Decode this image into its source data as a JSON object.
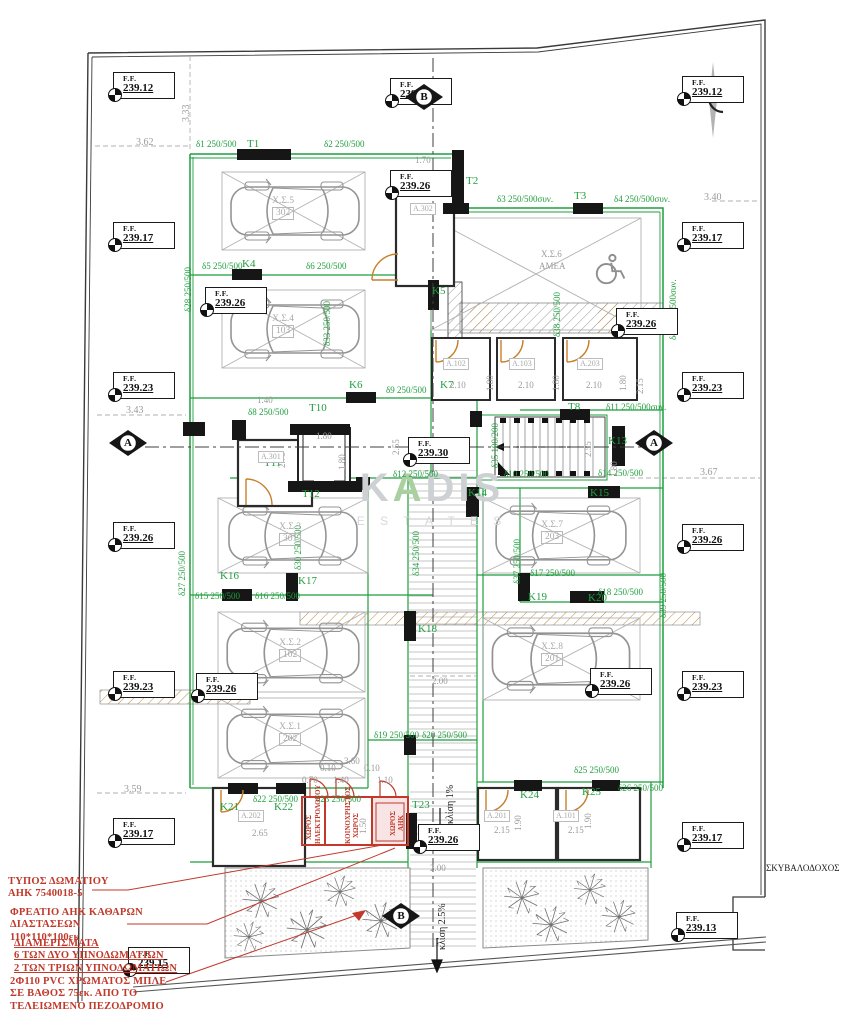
{
  "meta": {
    "width": 862,
    "height": 1024,
    "drawing": "ground floor / parking level plan"
  },
  "colors": {
    "structural_green": "#1f9e3e",
    "annotation_red": "#c0392b",
    "dim_gray": "#9b9b9b",
    "door_orange": "#c87f2a",
    "line_black": "#1a1a1a"
  },
  "watermark": {
    "k": "K",
    "a": "A",
    "dis": "DIS",
    "sub": "E S T A T E S"
  },
  "ff_label": "F.F.",
  "ff_markers": [
    {
      "x": 113,
      "y": 72,
      "v": "239.12"
    },
    {
      "x": 113,
      "y": 222,
      "v": "239.17"
    },
    {
      "x": 113,
      "y": 372,
      "v": "239.23"
    },
    {
      "x": 113,
      "y": 522,
      "v": "239.26"
    },
    {
      "x": 113,
      "y": 671,
      "v": "239.23"
    },
    {
      "x": 113,
      "y": 818,
      "v": "239.17"
    },
    {
      "x": 682,
      "y": 76,
      "v": "239.12"
    },
    {
      "x": 682,
      "y": 222,
      "v": "239.17"
    },
    {
      "x": 682,
      "y": 372,
      "v": "239.23"
    },
    {
      "x": 616,
      "y": 308,
      "v": "239.26"
    },
    {
      "x": 682,
      "y": 524,
      "v": "239.26"
    },
    {
      "x": 682,
      "y": 671,
      "v": "239.23"
    },
    {
      "x": 682,
      "y": 822,
      "v": "239.17"
    },
    {
      "x": 676,
      "y": 912,
      "v": "239.13"
    },
    {
      "x": 390,
      "y": 78,
      "v": "239.19"
    },
    {
      "x": 390,
      "y": 170,
      "v": "239.26"
    },
    {
      "x": 205,
      "y": 287,
      "v": "239.26"
    },
    {
      "x": 408,
      "y": 437,
      "v": "239.30"
    },
    {
      "x": 196,
      "y": 673,
      "v": "239.26"
    },
    {
      "x": 590,
      "y": 668,
      "v": "239.26"
    },
    {
      "x": 418,
      "y": 824,
      "v": "239.26"
    },
    {
      "x": 128,
      "y": 947,
      "v": "239.15"
    }
  ],
  "section_markers": [
    {
      "x": 404,
      "y": 80,
      "letter": "B"
    },
    {
      "x": 381,
      "y": 899,
      "letter": "B"
    },
    {
      "x": 108,
      "y": 426,
      "letter": "A"
    },
    {
      "x": 634,
      "y": 426,
      "letter": "A"
    }
  ],
  "parking_labels": [
    {
      "x": 272,
      "y": 196,
      "name": "Χ.Σ.5",
      "num": "302"
    },
    {
      "x": 272,
      "y": 314,
      "name": "Χ.Σ.4",
      "num": "103"
    },
    {
      "x": 279,
      "y": 522,
      "name": "Χ.Σ.3",
      "num": "301"
    },
    {
      "x": 279,
      "y": 638,
      "name": "Χ.Σ.2",
      "num": "102"
    },
    {
      "x": 279,
      "y": 722,
      "name": "Χ.Σ.1",
      "num": "202"
    },
    {
      "x": 541,
      "y": 520,
      "name": "Χ.Σ.7",
      "num": "203"
    },
    {
      "x": 541,
      "y": 642,
      "name": "Χ.Σ.8",
      "num": "201"
    }
  ],
  "room_labels": [
    {
      "x": 410,
      "y": 203,
      "t": "A.302"
    },
    {
      "x": 258,
      "y": 451,
      "t": "A.301"
    },
    {
      "x": 443,
      "y": 358,
      "t": "A.102"
    },
    {
      "x": 509,
      "y": 358,
      "t": "A.103"
    },
    {
      "x": 577,
      "y": 358,
      "t": "A.203"
    },
    {
      "x": 238,
      "y": 810,
      "t": "A.202"
    },
    {
      "x": 484,
      "y": 810,
      "t": "A.201"
    },
    {
      "x": 553,
      "y": 810,
      "t": "A.101"
    }
  ],
  "annotations": [
    {
      "x": 8,
      "y": 876,
      "underline": false,
      "lines": [
        "ΤΥΠΟΣ  ΔΩΜΑΤΙΟΥ",
        "ΑΗΚ  7540018-5"
      ]
    },
    {
      "x": 10,
      "y": 907,
      "underline": false,
      "lines": [
        "ΦΡΕΑΤΙΟ  ΑΗΚ  ΚΑΘΑΡΩΝ",
        "ΔΙΑΣΤΑΣΕΩΝ",
        "110*110*100εκ"
      ]
    },
    {
      "x": 14,
      "y": 938,
      "underline": true,
      "lines": [
        "      ΔΙΑΜΕΡΙΣΜΑΤΑ",
        "6  ΤΩΝ  ΔΥΟ  ΥΠΝΟΔΩΜΑΤΙΩΝ",
        "2  ΤΩΝ  ΤΡΙΩΝ  ΥΠΝΟΔΩΜΑΤΙΩΝ"
      ]
    },
    {
      "x": 10,
      "y": 976,
      "underline": false,
      "lines": [
        "2Φ110  PVC  ΧΡΩΜΑΤΟΣ  ΜΠΛΕ",
        "ΣΕ  ΒΑΘΟΣ  75εκ.  ΑΠΟ  ΤΟ",
        "ΤΕΛΕΙΩΜΕΝΟ  ΠΕΖΟΔΡΟΜΙΟ"
      ]
    }
  ],
  "texts": [
    {
      "t": "δ1 250/500",
      "x": 196,
      "y": 140,
      "c": "g"
    },
    {
      "t": "T1",
      "x": 247,
      "y": 139,
      "c": "g",
      "fs": 11
    },
    {
      "t": "δ2 250/500",
      "x": 324,
      "y": 140,
      "c": "g"
    },
    {
      "t": "δ3 250/500συν.",
      "x": 497,
      "y": 195,
      "c": "g"
    },
    {
      "t": "T3",
      "x": 574,
      "y": 191,
      "c": "g",
      "fs": 11
    },
    {
      "t": "δ4 250/500συν.",
      "x": 614,
      "y": 195,
      "c": "g"
    },
    {
      "t": "T2",
      "x": 466,
      "y": 176,
      "c": "g",
      "fs": 11
    },
    {
      "t": "δ5 250/500",
      "x": 202,
      "y": 262,
      "c": "g"
    },
    {
      "t": "K4",
      "x": 242,
      "y": 259,
      "c": "g",
      "fs": 11
    },
    {
      "t": "δ6 250/500",
      "x": 306,
      "y": 262,
      "c": "g"
    },
    {
      "t": "K5",
      "x": 432,
      "y": 286,
      "c": "g",
      "fs": 11
    },
    {
      "t": "δ28 250/500",
      "x": 184,
      "y": 312,
      "c": "g",
      "r": -90
    },
    {
      "t": "δ33 250/500",
      "x": 323,
      "y": 346,
      "c": "g",
      "r": -90
    },
    {
      "t": "δ9 250/500",
      "x": 386,
      "y": 386,
      "c": "g"
    },
    {
      "t": "K6",
      "x": 349,
      "y": 380,
      "c": "g",
      "fs": 11
    },
    {
      "t": "K7",
      "x": 440,
      "y": 380,
      "c": "g",
      "fs": 11
    },
    {
      "t": "δ8 250/500",
      "x": 248,
      "y": 408,
      "c": "g"
    },
    {
      "t": "T10",
      "x": 309,
      "y": 403,
      "c": "g",
      "fs": 11
    },
    {
      "t": "T11",
      "x": 264,
      "y": 458,
      "c": "g",
      "fs": 11
    },
    {
      "t": "T12",
      "x": 302,
      "y": 489,
      "c": "g",
      "fs": 11
    },
    {
      "t": "δ38 250/500",
      "x": 553,
      "y": 337,
      "c": "g",
      "r": -90
    },
    {
      "t": "δ40 250/500συν.",
      "x": 669,
      "y": 340,
      "c": "g",
      "r": -90
    },
    {
      "t": "T8",
      "x": 568,
      "y": 402,
      "c": "g",
      "fs": 11
    },
    {
      "t": "δ11 250/500συν.",
      "x": 606,
      "y": 403,
      "c": "g"
    },
    {
      "t": "δ10 250/500",
      "x": 504,
      "y": 470,
      "c": "g"
    },
    {
      "t": "δ35 100/200",
      "x": 491,
      "y": 468,
      "c": "g",
      "r": -90
    },
    {
      "t": "K13",
      "x": 608,
      "y": 436,
      "c": "g",
      "fs": 11
    },
    {
      "t": "δ12 250/500",
      "x": 393,
      "y": 470,
      "c": "g"
    },
    {
      "t": "δ14 250/500",
      "x": 598,
      "y": 469,
      "c": "g"
    },
    {
      "t": "K14",
      "x": 468,
      "y": 488,
      "c": "g",
      "fs": 11
    },
    {
      "t": "K15",
      "x": 590,
      "y": 488,
      "c": "g",
      "fs": 11
    },
    {
      "t": "δ37 250/500",
      "x": 513,
      "y": 584,
      "c": "g",
      "r": -90
    },
    {
      "t": "δ17 250/500",
      "x": 530,
      "y": 569,
      "c": "g"
    },
    {
      "t": "δ18 250/500",
      "x": 598,
      "y": 588,
      "c": "g"
    },
    {
      "t": "K19",
      "x": 528,
      "y": 592,
      "c": "g",
      "fs": 11
    },
    {
      "t": "K20",
      "x": 588,
      "y": 593,
      "c": "g",
      "fs": 11
    },
    {
      "t": "δ39 250/500",
      "x": 659,
      "y": 618,
      "c": "g",
      "r": -90
    },
    {
      "t": "δ27 250/500",
      "x": 178,
      "y": 596,
      "c": "g",
      "r": -90
    },
    {
      "t": "K16",
      "x": 220,
      "y": 571,
      "c": "g",
      "fs": 11
    },
    {
      "t": "K17",
      "x": 298,
      "y": 576,
      "c": "g",
      "fs": 11
    },
    {
      "t": "δ15 250/500",
      "x": 195,
      "y": 592,
      "c": "g"
    },
    {
      "t": "δ16 250/500",
      "x": 255,
      "y": 592,
      "c": "g"
    },
    {
      "t": "δ30 250/500",
      "x": 294,
      "y": 570,
      "c": "g",
      "r": -90
    },
    {
      "t": "δ34 250/500",
      "x": 412,
      "y": 576,
      "c": "g",
      "r": -90
    },
    {
      "t": "K18",
      "x": 418,
      "y": 624,
      "c": "g",
      "fs": 11
    },
    {
      "t": "δ19 250/500",
      "x": 374,
      "y": 731,
      "c": "g"
    },
    {
      "t": "δ20 250/500",
      "x": 422,
      "y": 731,
      "c": "g"
    },
    {
      "t": "δ22 250/500",
      "x": 253,
      "y": 795,
      "c": "g"
    },
    {
      "t": "δ23 250/500",
      "x": 316,
      "y": 795,
      "c": "g"
    },
    {
      "t": "K21",
      "x": 220,
      "y": 802,
      "c": "g",
      "fs": 11
    },
    {
      "t": "K22",
      "x": 274,
      "y": 802,
      "c": "g",
      "fs": 11
    },
    {
      "t": "T23",
      "x": 412,
      "y": 800,
      "c": "g",
      "fs": 11
    },
    {
      "t": "K24",
      "x": 520,
      "y": 790,
      "c": "g",
      "fs": 11
    },
    {
      "t": "K25",
      "x": 582,
      "y": 787,
      "c": "g",
      "fs": 11
    },
    {
      "t": "δ25 250/500",
      "x": 574,
      "y": 766,
      "c": "g"
    },
    {
      "t": "δ26 250/500",
      "x": 618,
      "y": 784,
      "c": "g"
    },
    {
      "t": "3.62",
      "x": 136,
      "y": 138,
      "c": "d",
      "fs": 10
    },
    {
      "t": "3.33",
      "x": 182,
      "y": 122,
      "c": "d",
      "r": -90,
      "fs": 10
    },
    {
      "t": "3.40",
      "x": 704,
      "y": 193,
      "c": "d",
      "fs": 10
    },
    {
      "t": "3.43",
      "x": 126,
      "y": 406,
      "c": "d",
      "fs": 10
    },
    {
      "t": "3.67",
      "x": 700,
      "y": 468,
      "c": "d",
      "fs": 10
    },
    {
      "t": "3.59",
      "x": 124,
      "y": 785,
      "c": "d",
      "fs": 10
    },
    {
      "t": "1.70",
      "x": 415,
      "y": 156,
      "c": "d"
    },
    {
      "t": "2.10",
      "x": 450,
      "y": 381,
      "c": "d"
    },
    {
      "t": "2.10",
      "x": 518,
      "y": 381,
      "c": "d"
    },
    {
      "t": "2.10",
      "x": 586,
      "y": 381,
      "c": "d"
    },
    {
      "t": "1.80",
      "x": 486,
      "y": 391,
      "c": "d",
      "r": -90
    },
    {
      "t": "1.80",
      "x": 552,
      "y": 391,
      "c": "d",
      "r": -90
    },
    {
      "t": "1.80",
      "x": 619,
      "y": 391,
      "c": "d",
      "r": -90
    },
    {
      "t": "2.15",
      "x": 636,
      "y": 394,
      "c": "d",
      "r": -90
    },
    {
      "t": "2.55",
      "x": 392,
      "y": 455,
      "c": "d",
      "r": -90
    },
    {
      "t": "2.55",
      "x": 584,
      "y": 457,
      "c": "d",
      "r": -90
    },
    {
      "t": "2.75",
      "x": 278,
      "y": 468,
      "c": "d",
      "r": -90
    },
    {
      "t": "1.80",
      "x": 316,
      "y": 432,
      "c": "d"
    },
    {
      "t": "1.80",
      "x": 338,
      "y": 470,
      "c": "d",
      "r": -90
    },
    {
      "t": "1.40",
      "x": 257,
      "y": 396,
      "c": "d"
    },
    {
      "t": "1.80",
      "x": 610,
      "y": 477,
      "c": "d",
      "r": -90
    },
    {
      "t": "2.00",
      "x": 432,
      "y": 677,
      "c": "d"
    },
    {
      "t": "2.00",
      "x": 430,
      "y": 864,
      "c": "d"
    },
    {
      "t": "1.90",
      "x": 514,
      "y": 831,
      "c": "d",
      "r": -90
    },
    {
      "t": "1.90",
      "x": 584,
      "y": 829,
      "c": "d",
      "r": -90
    },
    {
      "t": "2.15",
      "x": 494,
      "y": 826,
      "c": "d"
    },
    {
      "t": "2.15",
      "x": 568,
      "y": 826,
      "c": "d"
    },
    {
      "t": "2.65",
      "x": 252,
      "y": 829,
      "c": "d"
    },
    {
      "t": "3.60",
      "x": 344,
      "y": 757,
      "c": "d"
    },
    {
      "t": "0.10",
      "x": 320,
      "y": 764,
      "c": "d"
    },
    {
      "t": "0.10",
      "x": 364,
      "y": 764,
      "c": "d"
    },
    {
      "t": "0.70",
      "x": 302,
      "y": 776,
      "c": "d"
    },
    {
      "t": "1.40",
      "x": 333,
      "y": 776,
      "c": "d"
    },
    {
      "t": "1.10",
      "x": 377,
      "y": 776,
      "c": "d"
    },
    {
      "t": "1.50",
      "x": 359,
      "y": 834,
      "c": "d",
      "r": -90
    },
    {
      "t": "Χ.Σ.6",
      "x": 541,
      "y": 250,
      "c": "d"
    },
    {
      "t": "ΑΜΕΑ",
      "x": 539,
      "y": 262,
      "c": "d"
    },
    {
      "t": "κλίση 1%",
      "x": 446,
      "y": 824,
      "c": "k",
      "r": -90,
      "fs": 10
    },
    {
      "t": "κλίση 2.5%",
      "x": 438,
      "y": 950,
      "c": "k",
      "r": -90,
      "fs": 10
    },
    {
      "t": "ΣΚΥΒΑΛΟΔΟΧΟΣ",
      "x": 766,
      "y": 864,
      "c": "k",
      "fs": 9
    },
    {
      "t": "ΧΩΡΟΣ",
      "x": 306,
      "y": 840,
      "c": "r",
      "r": -90,
      "fs": 7
    },
    {
      "t": "ΗΛΕΚΤΡΟΛΟΓΟΥ",
      "x": 315,
      "y": 844,
      "c": "r",
      "r": -90,
      "fs": 7
    },
    {
      "t": "ΚΟΙΝΟΧΡΗΣΤΟΣ",
      "x": 345,
      "y": 844,
      "c": "r",
      "r": -90,
      "fs": 7
    },
    {
      "t": "ΧΩΡΟΣ",
      "x": 353,
      "y": 838,
      "c": "r",
      "r": -90,
      "fs": 7
    },
    {
      "t": "ΧΩΡΟΣ",
      "x": 390,
      "y": 836,
      "c": "r",
      "r": -90,
      "fs": 7
    },
    {
      "t": "ΑΗΚ",
      "x": 398,
      "y": 831,
      "c": "r",
      "r": -90,
      "fs": 7
    }
  ]
}
